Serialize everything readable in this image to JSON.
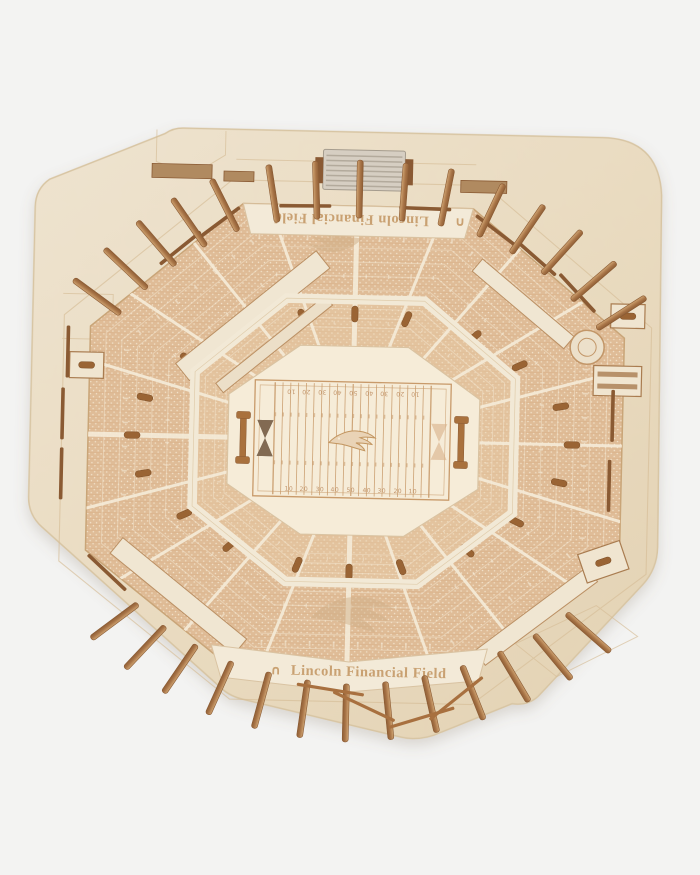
{
  "product": {
    "description_label": "wooden-3d-stadium-model-overhead",
    "name_engraving_bottom": "Lincoln Financial Field",
    "name_engraving_top": "Lincoln Financial Field",
    "brand_mark": "∩",
    "field": {
      "yard_numbers": [
        "10",
        "20",
        "30",
        "40",
        "50",
        "40",
        "30",
        "20",
        "10"
      ],
      "center_logo": "philadelphia-eagles-logo"
    },
    "colors": {
      "background": "#f3f3f2",
      "base_wood": "#ecdfc9",
      "base_wood_dark": "#e1d0b2",
      "platform_wood": "#f6ecd8",
      "seat_wood": "#dfbc97",
      "aisle_wood": "#f5ecd9",
      "engraving": "#c89a6a",
      "band_wood": "#f3ead8",
      "peg_wood_light": "#cfa472",
      "peg_wood_dark": "#8f5f36",
      "rail_wood": "#8a5a33",
      "tunnel_wood": "#9a6434",
      "scoreboard_gray": "#d6cec2"
    }
  }
}
